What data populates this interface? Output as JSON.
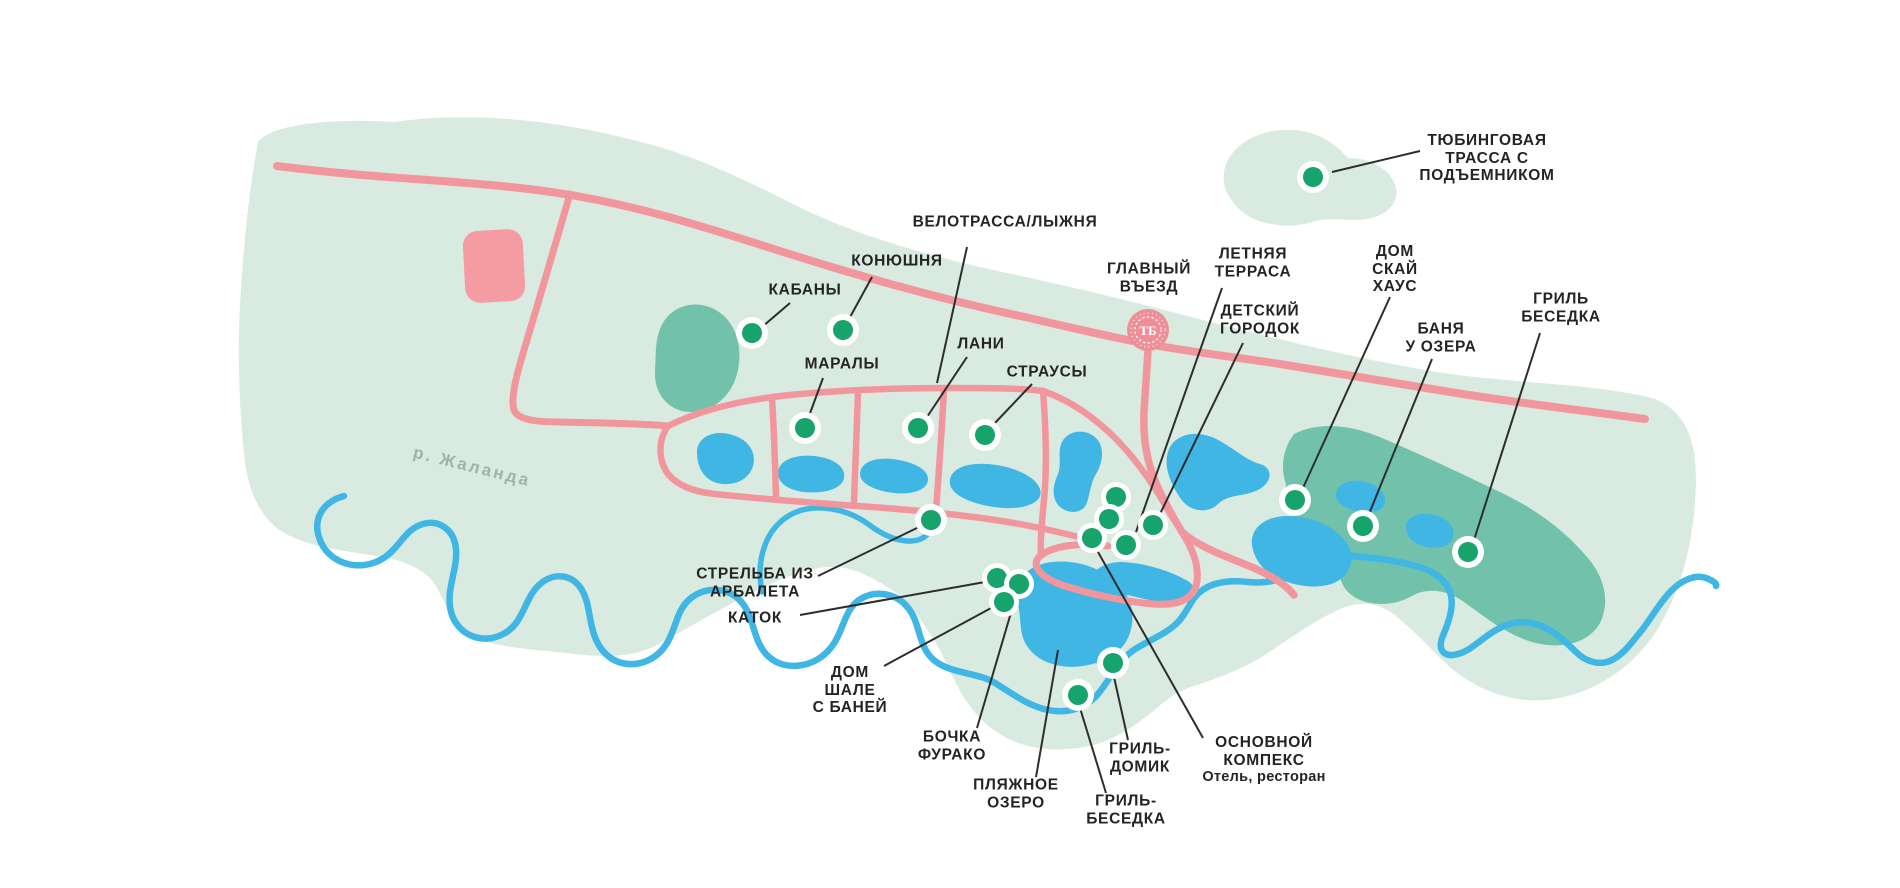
{
  "labels": {
    "tubing": {
      "lines": [
        "ТЮБИНГОВАЯ",
        "ТРАССА С",
        "ПОДЪЕМНИКОМ"
      ]
    },
    "velotrassa": {
      "lines": [
        "ВЕЛОТРАССА/ЛЫЖНЯ"
      ]
    },
    "konyushnya": {
      "lines": [
        "КОНЮШНЯ"
      ]
    },
    "kabany": {
      "lines": [
        "КАБАНЫ"
      ]
    },
    "maraly": {
      "lines": [
        "МАРАЛЫ"
      ]
    },
    "lani": {
      "lines": [
        "ЛАНИ"
      ]
    },
    "strausy": {
      "lines": [
        "СТРАУСЫ"
      ]
    },
    "glavny_vezd": {
      "lines": [
        "ГЛАВНЫЙ",
        "ВЪЕЗД"
      ]
    },
    "letnyaya_terrasa": {
      "lines": [
        "ЛЕТНЯЯ",
        "ТЕРРАСА"
      ]
    },
    "detsky_gorodok": {
      "lines": [
        "ДЕТСКИЙ",
        "ГОРОДОК"
      ]
    },
    "dom_skai_haus": {
      "lines": [
        "ДОМ",
        "СКАЙ",
        "ХАУС"
      ]
    },
    "banya_u_ozera": {
      "lines": [
        "БАНЯ",
        "У ОЗЕРА"
      ]
    },
    "gril_besedka_right": {
      "lines": [
        "ГРИЛЬ",
        "БЕСЕДКА"
      ]
    },
    "strelba": {
      "lines": [
        "СТРЕЛЬБА ИЗ",
        "АРБАЛЕТА"
      ]
    },
    "katok": {
      "lines": [
        "КАТОК"
      ]
    },
    "dom_shale": {
      "lines": [
        "ДОМ",
        "ШАЛЕ",
        "С БАНЕЙ"
      ]
    },
    "bochka_furako": {
      "lines": [
        "БОЧКА",
        "ФУРАКО"
      ]
    },
    "plyazhnoe_ozero": {
      "lines": [
        "ПЛЯЖНОЕ",
        "ОЗЕРО"
      ]
    },
    "gril_domik": {
      "lines": [
        "ГРИЛЬ-",
        "ДОМИК"
      ]
    },
    "gril_besedka_bottom": {
      "lines": [
        "ГРИЛЬ-",
        "БЕСЕДКА"
      ]
    },
    "osnovnoy_kompleks": {
      "lines": [
        "ОСНОВНОЙ",
        "КОМПЕКС"
      ],
      "sub": "Отель, ресторан"
    },
    "river": {
      "lines": [
        "р. Жаланда"
      ]
    }
  },
  "entrance": {
    "monogram": "ТБ"
  },
  "colors": {
    "land": "#d9ebe1",
    "forest": "#72c2ab",
    "water": "#3fb6e3",
    "road": "#f2969d",
    "marker": "#17a46c",
    "marker_ring": "#ffffff",
    "entrance_circle": "#ee8e96",
    "building": "#f59ba2",
    "label_text": "#242424",
    "river_label_text": "#9fb2ab"
  }
}
